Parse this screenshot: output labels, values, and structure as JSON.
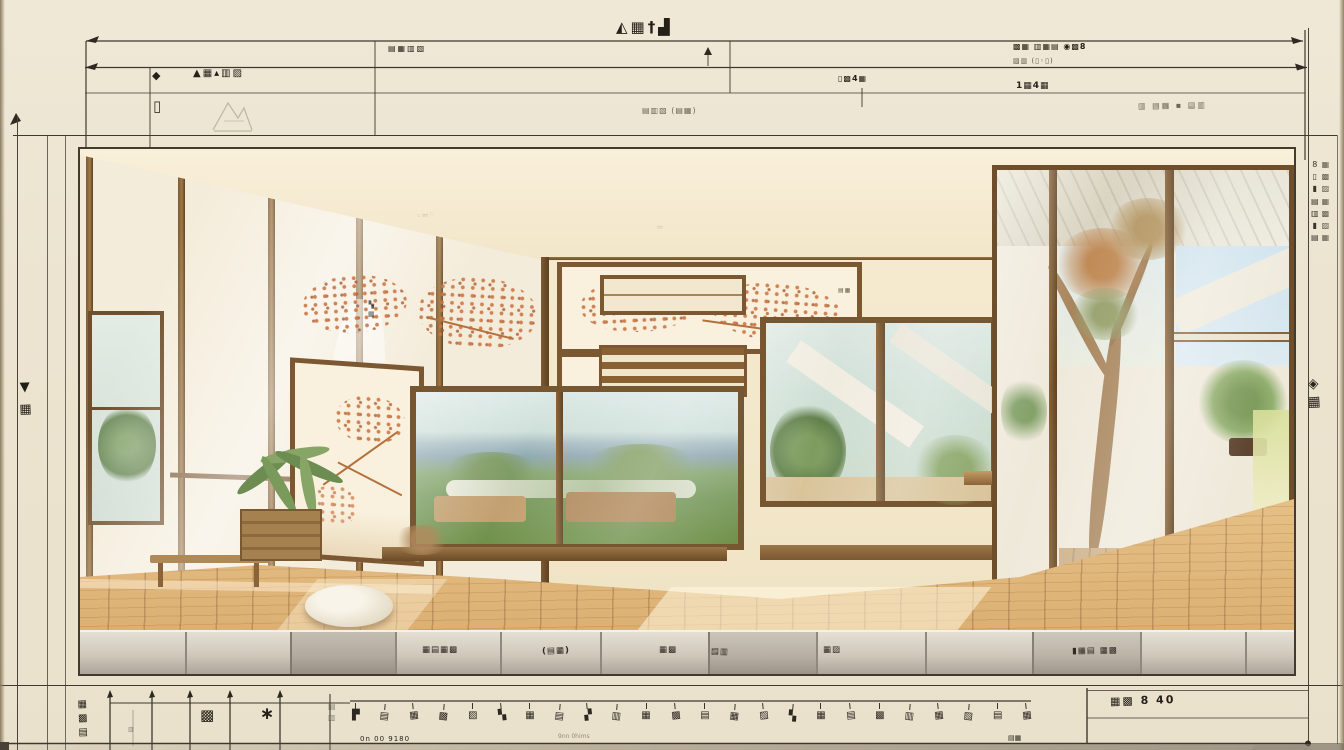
{
  "colors": {
    "paper": "#ece4d0",
    "ink": "#2c2720",
    "wood": "#7b5832",
    "floor_wood": "#d9ab6e",
    "accent_blossom": "#cb7644"
  },
  "top": {
    "title": "◭▦†▟",
    "row1_left": "▤▦▥▧",
    "row1_right_a": "▩▦ ▥▦▤ ◉▩8",
    "row1_right_b": "▨▥ (▯◦▯)",
    "row2_marker": "◆",
    "row2_left": "▲▦▴▥▨",
    "row2_mid": "▯▩4▦",
    "row2_right": "1▦4▦",
    "row3_left": "▯",
    "row3_mid": "▤▥▧ (▤▦)",
    "row3_right": "▥ ▤▦ ▪ ▤▥"
  },
  "left_margin": {
    "glyphs": [
      "▼",
      "▦"
    ]
  },
  "right_margin": {
    "col_a": [
      "8",
      "▯",
      "▮",
      "▤",
      "▥",
      "▮",
      "▤"
    ],
    "col_b": [
      "▦",
      "▩",
      "▨",
      "▦",
      "▩",
      "▨",
      "▦"
    ],
    "seal": [
      "◈",
      "▦"
    ]
  },
  "render": {
    "ceiling_mark_a": "◦≈◦",
    "ceiling_mark_b": "≈",
    "wall_mark": "▤▦",
    "panel_seal": [
      "▚",
      "▦"
    ],
    "base_stamps": [
      "▦▤▦▩",
      "(▤▦)",
      "▦▩",
      "▤▥",
      "▦▨",
      "▮▦▤ ▦▩"
    ]
  },
  "bottom": {
    "legend_stack": [
      "▦",
      "▩",
      "▤"
    ],
    "legend_hair": "▥",
    "stamp_a": "▩",
    "stamp_b": "∗",
    "legend_stack_b": [
      "▤",
      "▥"
    ],
    "scale_glyphs": [
      "▛",
      "▤",
      "▦",
      "▩",
      "▨",
      "▚",
      "▦",
      "▤",
      "▞",
      "▥",
      "▦",
      "▩",
      "▤",
      "▦",
      "▨",
      "▚",
      "▦",
      "▤",
      "▩",
      "▥",
      "▦",
      "▨",
      "▤",
      "▦"
    ],
    "note_left": "0n 00 9180",
    "note_mid": "9nn 0hims",
    "note_right": "▤▦",
    "right_label": "▦▩ 8 40"
  }
}
